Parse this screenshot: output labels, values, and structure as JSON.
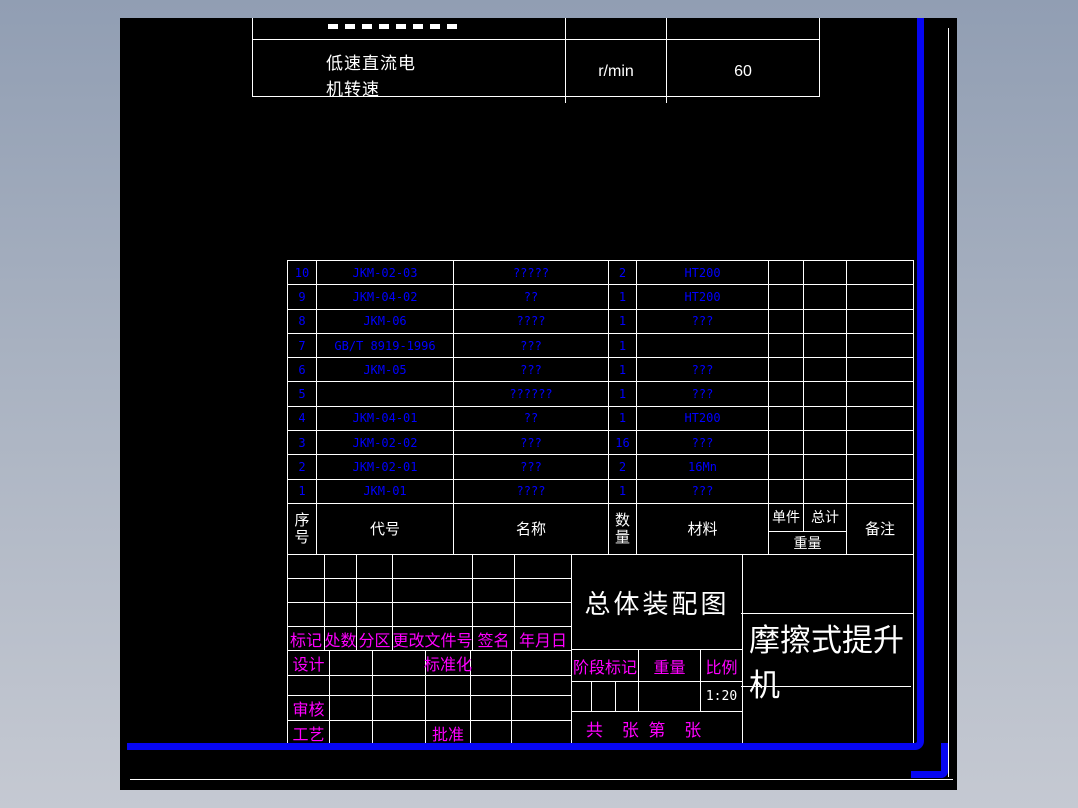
{
  "colors": {
    "background_top": "#919eb3",
    "background_bottom": "#c5c9d2",
    "canvas": "#000000",
    "line_white": "#ffffff",
    "frame_blue": "#0606f2",
    "bom_text_blue": "#0000ff",
    "label_magenta": "#ff00ff"
  },
  "spec_table": {
    "row": {
      "label": "低速直流电机转速",
      "unit": "r/min",
      "value": "60"
    }
  },
  "bom_table": {
    "headers": {
      "seq": "序号",
      "code": "代号",
      "name": "名称",
      "qty": "数量",
      "material": "材料",
      "unit_weight": "单件",
      "total_weight": "总计",
      "weight": "重量",
      "remark": "备注"
    },
    "rows": [
      {
        "seq": "10",
        "code": "JKM-02-03",
        "name": "?????",
        "qty": "2",
        "material": "HT200"
      },
      {
        "seq": "9",
        "code": "JKM-04-02",
        "name": "??",
        "qty": "1",
        "material": "HT200"
      },
      {
        "seq": "8",
        "code": "JKM-06",
        "name": "????",
        "qty": "1",
        "material": "???"
      },
      {
        "seq": "7",
        "code": "GB/T 8919-1996",
        "name": "???",
        "qty": "1",
        "material": ""
      },
      {
        "seq": "6",
        "code": "JKM-05",
        "name": "???",
        "qty": "1",
        "material": "???"
      },
      {
        "seq": "5",
        "code": "",
        "name": "??????",
        "qty": "1",
        "material": "???"
      },
      {
        "seq": "4",
        "code": "JKM-04-01",
        "name": "??",
        "qty": "1",
        "material": "HT200"
      },
      {
        "seq": "3",
        "code": "JKM-02-02",
        "name": "???",
        "qty": "16",
        "material": "???"
      },
      {
        "seq": "2",
        "code": "JKM-02-01",
        "name": "???",
        "qty": "2",
        "material": "16Mn"
      },
      {
        "seq": "1",
        "code": "JKM-01",
        "name": "????",
        "qty": "1",
        "material": "???"
      }
    ]
  },
  "title_block": {
    "revision_headers": [
      "标记",
      "处数",
      "分区",
      "更改文件号",
      "签名",
      "年月日"
    ],
    "labels": {
      "design": "设计",
      "standardization": "标准化",
      "review": "审核",
      "process": "工艺",
      "approve": "批准"
    },
    "drawing_title": "总体装配图",
    "product_name": "摩擦式提升机",
    "stage_mark": "阶段标记",
    "weight": "重量",
    "scale_label": "比例",
    "scale_value": "1:20",
    "sheet_info": "共    张  第    张"
  }
}
